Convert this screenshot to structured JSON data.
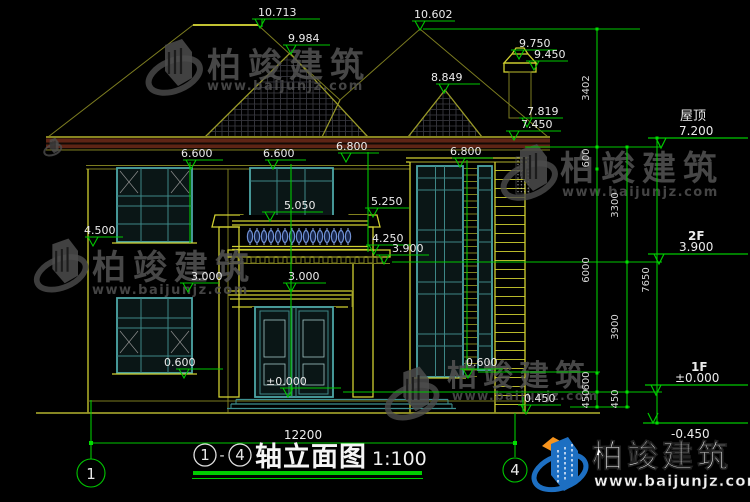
{
  "title": {
    "axis_start": "1",
    "axis_end": "4",
    "dash": "-",
    "name": "轴立面图",
    "scale": "1:100"
  },
  "axes": {
    "left": "1",
    "right": "4"
  },
  "levels": {
    "ridge_left": "10.713",
    "ridge_right": "10.602",
    "gable_front": "9.984",
    "chimney_top": "9.750",
    "chimney_cap": "9.450",
    "gable_side": "8.849",
    "fascia_top": "7.819",
    "eaves": "7.450",
    "wall_top_left": "6.600",
    "wall_top_center": "6.600",
    "wall_top_mid": "6.800",
    "wall_top_right": "6.800",
    "railing_top": "5.050",
    "band_right": "5.250",
    "sill_2f_left": "4.500",
    "balcony_floor": "4.250",
    "floor_2f": "3.900",
    "canopy_top": "3.000",
    "lintel_1f_left": "3.000",
    "entry": "±0.000",
    "sill_1f_left": "0.600",
    "sill_1f_right": "0.600",
    "plinth_right": "0.450"
  },
  "elevation_table": {
    "roof_label": "屋顶",
    "roof_value": "7.200",
    "f2_label": "2F",
    "f2_value": "3.900",
    "f1_label": "1F",
    "f1_value": "±0.000",
    "ground_value": "-0.450"
  },
  "dimensions": {
    "total_width": "12200",
    "chain_inner": [
      "3402",
      "600",
      "6000",
      "600",
      "450"
    ],
    "chain_mid": [
      "3300",
      "3900",
      "450"
    ],
    "chain_outer": "7650"
  },
  "watermark": {
    "brand": "柏竣建筑",
    "url": "www.baijunjz.com"
  },
  "footer_logo": {
    "brand": "柏竣建筑",
    "url": "www.baijunjz.com"
  },
  "colors": {
    "dimension_green": "#00c800",
    "building_olive": "#8a8a20",
    "accent_yellow": "#cfcf30",
    "window_teal": "#4da6a6",
    "fascia_maroon": "#5e2415",
    "baluster_blue": "#6f8fd2",
    "logo_blue": "#1d6fc2",
    "logo_orange": "#f7941d"
  }
}
